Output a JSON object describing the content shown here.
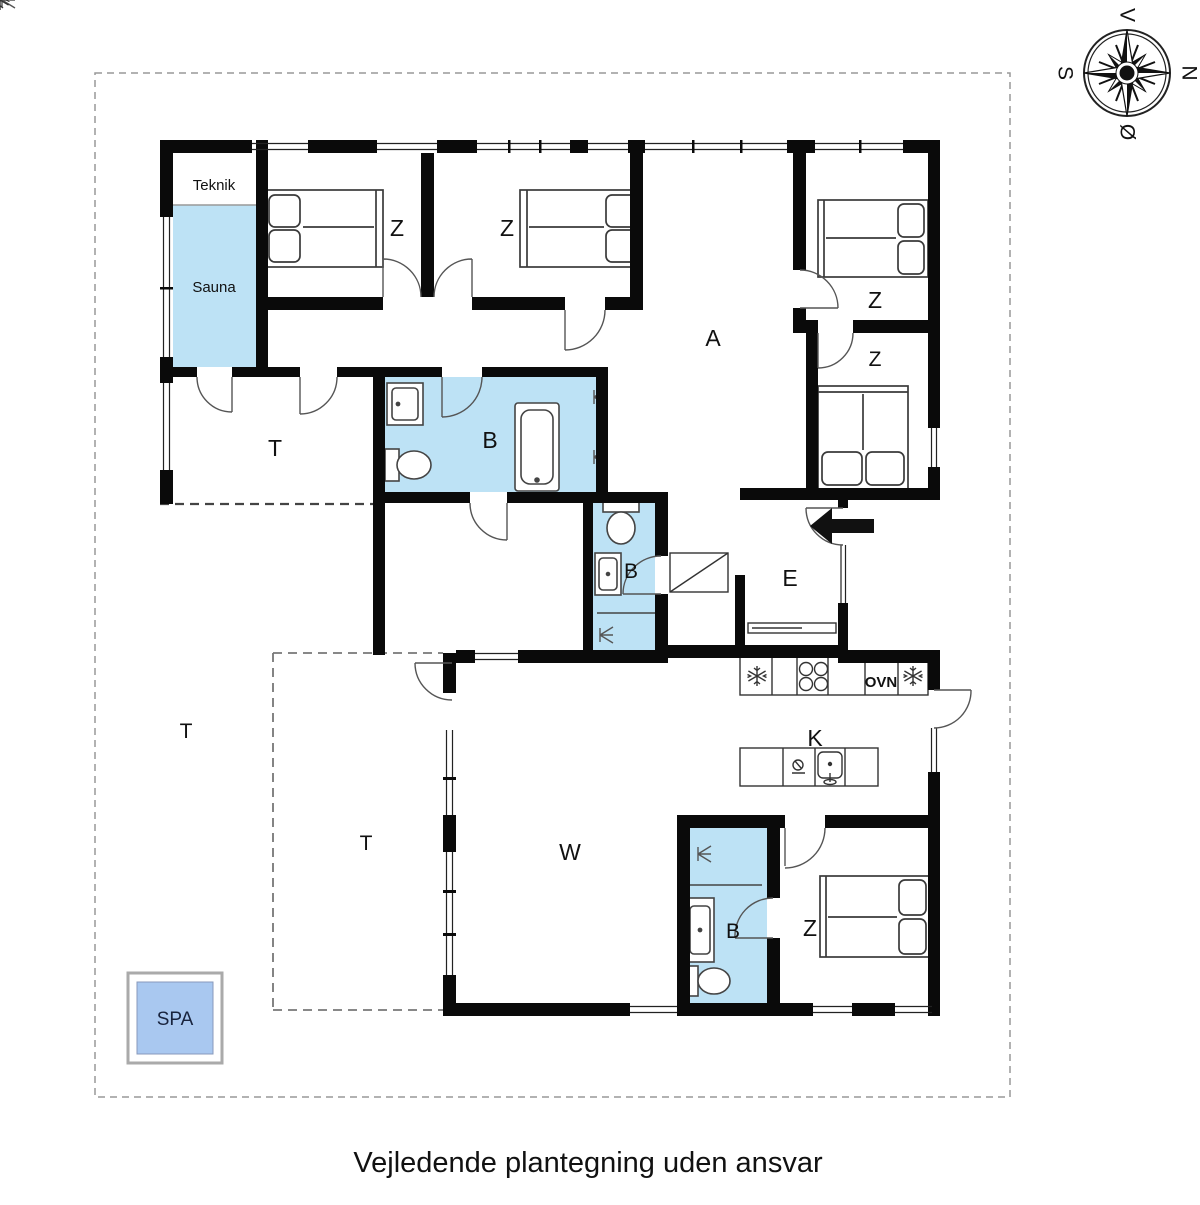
{
  "caption": "Vejledende plantegning uden ansvar",
  "compass": {
    "top": "V",
    "right": "N",
    "bottom": "Ø",
    "left": "S"
  },
  "rooms": {
    "teknik": "Teknik",
    "sauna": "Sauna",
    "bedroom": "Z",
    "hallway": "A",
    "terrace": "T",
    "bathroom": "B",
    "entrance": "E",
    "kitchen": "K",
    "living_room": "W",
    "spa": "SPA",
    "oven": "OVN"
  },
  "colors": {
    "wall": "#0a0a0a",
    "room_fill": "#bde2f5",
    "spa_fill": "#a9c8f0",
    "fixture_line": "#555555",
    "boundary_dash": "#999999"
  }
}
